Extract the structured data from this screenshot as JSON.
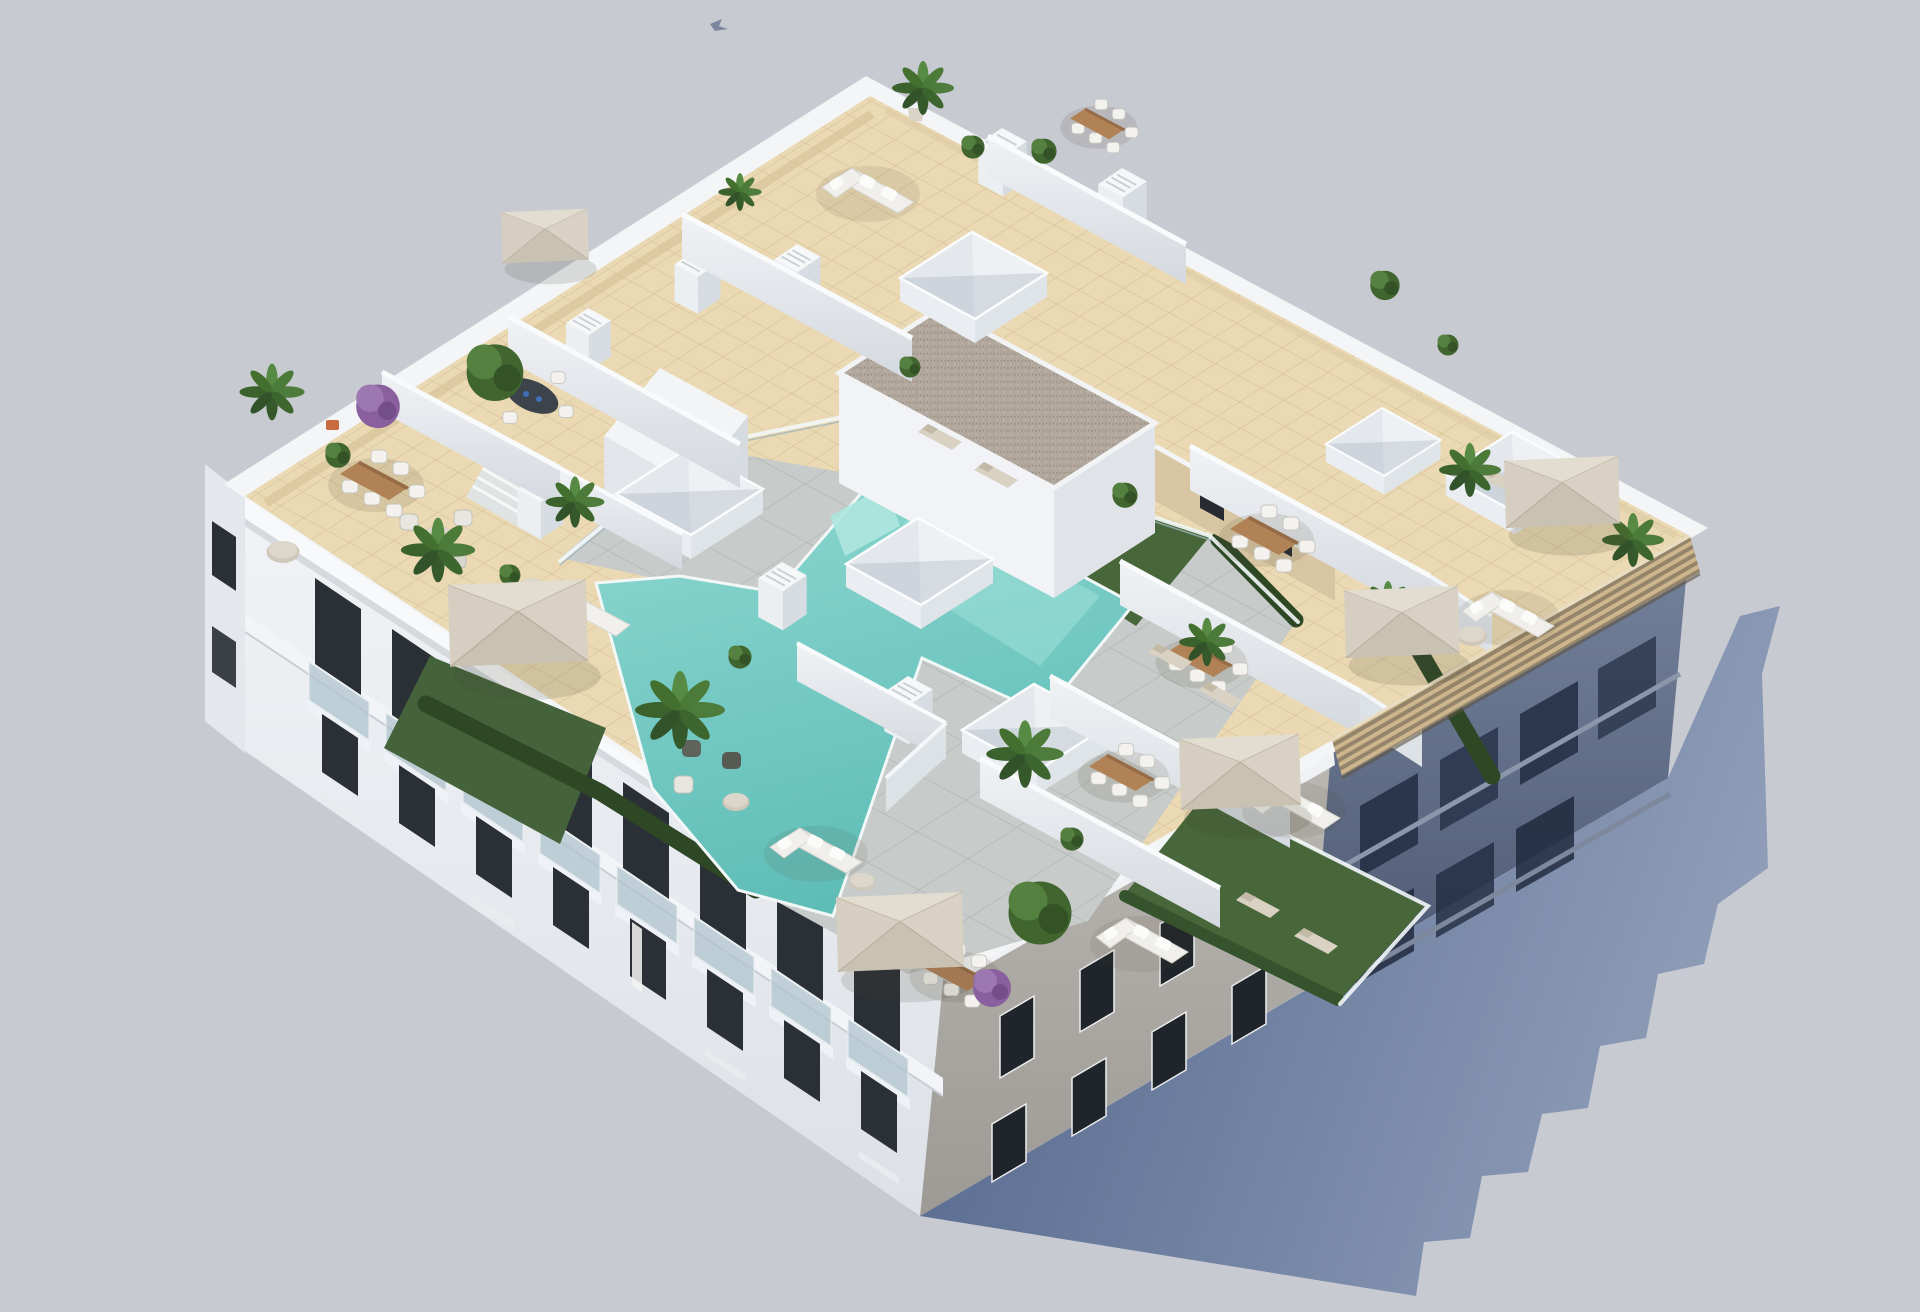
{
  "labels": {
    "title": "Aerial 3D architectural render of an apartment building rooftop with terraces and communal pool",
    "description": "Isometric aerial view of a white four-storey apartment block. The rooftop is divided by white walls into private cream-tiled terraces with wooden dining tables, white chairs, beige cantilever parasols, white lounge sofas, sun loungers and many potted palms and bougainvillea. A communal deck on the left holds an L-shaped turquoise pool with grey stone paving, artificial grass, glass balustrades and hedges. A central raised volume has a gravel flat roof; white pyramid skylights and louvred chimneys dot the deck. A slatted timber pergola runs along the shaded south-east edge and the building casts a long blue-grey shadow to the lower right."
  },
  "scene": {
    "kind": "3d-architectural-render",
    "view": "aerial-isometric",
    "background_color": "#c8cad2",
    "shadow_color": "#5e7094"
  },
  "building": {
    "storeys_visible": 4,
    "facade_sunlit_color": "#eef0f4",
    "facade_shaded_color": "#6b7892",
    "facade_side_greige_color": "#b6b3ae",
    "window_color": "#2b3036",
    "balcony_glass_color": "#b9c6cc"
  },
  "rooftop": {
    "tile_color": "#ead9b3",
    "gravel_roof_color": "#b2a79c",
    "pergola_slat_color": "#cdb68e",
    "parasol_color": "#d5cec1",
    "parasols": 7,
    "skylights": 6,
    "chimneys": 8,
    "dining_sets": 7,
    "lounge_sofas": 6,
    "sun_loungers": 7,
    "pool": {
      "shape": "L-shaped",
      "water_color": "#72cbc6",
      "deck_color": "#c7cbca",
      "grass_color": "#47663a",
      "hedge_color": "#2e4826",
      "glass_balustrade": true
    },
    "plants": {
      "palms": 11,
      "green_bushes": 10,
      "purple_bougainvillea": 2
    }
  }
}
